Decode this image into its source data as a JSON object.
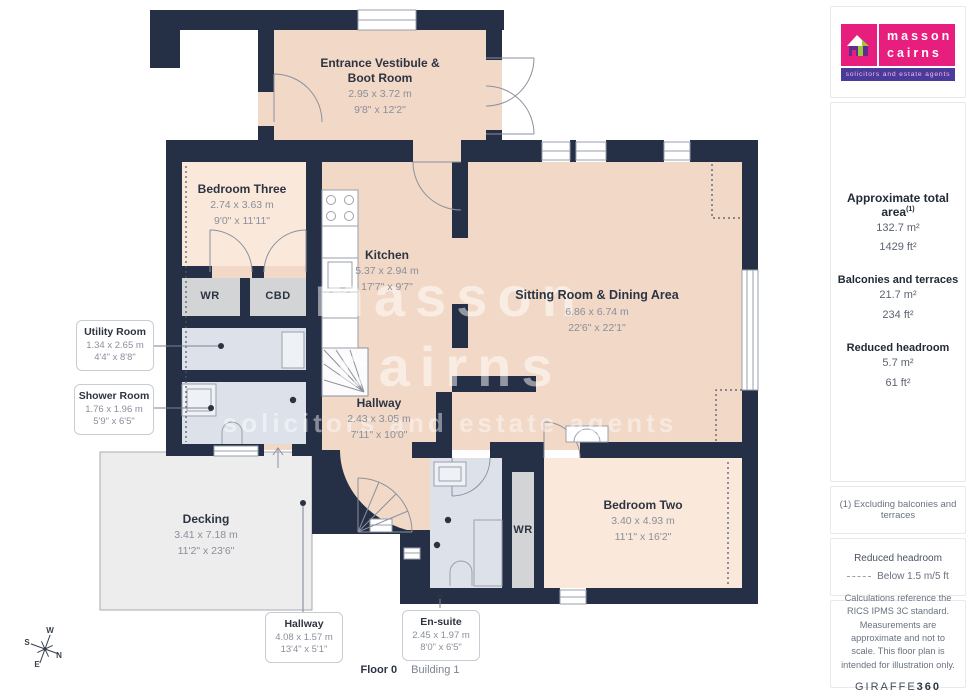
{
  "branding": {
    "agency_line1": "masson",
    "agency_line2": "cairns",
    "tagline": "solicitors and estate agents",
    "colors": {
      "brand_pink": "#e71e7e",
      "brand_purple_strip": "#4a3a9c",
      "house_purple": "#5f2c8f",
      "house_lime": "#9bc93d"
    }
  },
  "plan_colors": {
    "wall": "#252f45",
    "room_warm": "#f1d8c7",
    "room_light": "#fae9da",
    "room_bath": "#dde2ea",
    "room_closet": "#d3d4d6",
    "decking": "#ededee"
  },
  "rooms": [
    {
      "name": "Entrance Vestibule & Boot Room",
      "metric": "2.95 x 3.72 m",
      "imperial": "9'8\" x 12'2\""
    },
    {
      "name": "Bedroom Three",
      "metric": "2.74 x 3.63 m",
      "imperial": "9'0\" x 11'11\""
    },
    {
      "name": "Kitchen",
      "metric": "5.37 x 2.94 m",
      "imperial": "17'7\" x 9'7\""
    },
    {
      "name": "Sitting Room & Dining Area",
      "metric": "6.86 x 6.74 m",
      "imperial": "22'6\" x 22'1\""
    },
    {
      "name": "Hallway",
      "metric": "2.43 x 3.05 m",
      "imperial": "7'11\" x 10'0\""
    },
    {
      "name": "Bedroom Two",
      "metric": "3.40 x 4.93 m",
      "imperial": "11'1\" x 16'2\""
    },
    {
      "name": "Decking",
      "metric": "3.41 x 7.18 m",
      "imperial": "11'2\" x 23'6\""
    }
  ],
  "callouts": [
    {
      "name": "Utility Room",
      "metric": "1.34 x 2.65 m",
      "imperial": "4'4\" x 8'8\""
    },
    {
      "name": "Shower Room",
      "metric": "1.76 x 1.96 m",
      "imperial": "5'9\" x 6'5\""
    },
    {
      "name": "Hallway",
      "metric": "4.08 x 1.57 m",
      "imperial": "13'4\" x 5'1\""
    },
    {
      "name": "En-suite",
      "metric": "2.45 x 1.97 m",
      "imperial": "8'0\" x 6'5\""
    }
  ],
  "closets": {
    "wr_upper": "WR",
    "cbd": "CBD",
    "wr_lower": "WR"
  },
  "compass": {
    "n": "N",
    "s": "S",
    "e": "E",
    "w": "W"
  },
  "watermark": {
    "line1": "masson",
    "line2": "cairns",
    "line3": "solicitors and estate agents"
  },
  "sidebar": {
    "total_area": {
      "label": "Approximate total area",
      "footnote_marker": "(1)",
      "m2": "132.7 m²",
      "ft2": "1429 ft²"
    },
    "balconies": {
      "label": "Balconies and terraces",
      "m2": "21.7 m²",
      "ft2": "234 ft²"
    },
    "reduced_headroom": {
      "label": "Reduced headroom",
      "m2": "5.7 m²",
      "ft2": "61 ft²"
    },
    "footnote": "(1) Excluding balconies and terraces",
    "legend": {
      "title": "Reduced headroom",
      "entry": "Below 1.5 m/5 ft"
    },
    "disclaimer": "Calculations reference the RICS IPMS 3C standard. Measurements are approximate and not to scale. This floor plan is intended for illustration only.",
    "provider": {
      "name_regular": "GIRAFFE",
      "name_bold": "360"
    }
  },
  "footer": {
    "floor_label": "Floor 0",
    "building_label": "Building 1"
  }
}
